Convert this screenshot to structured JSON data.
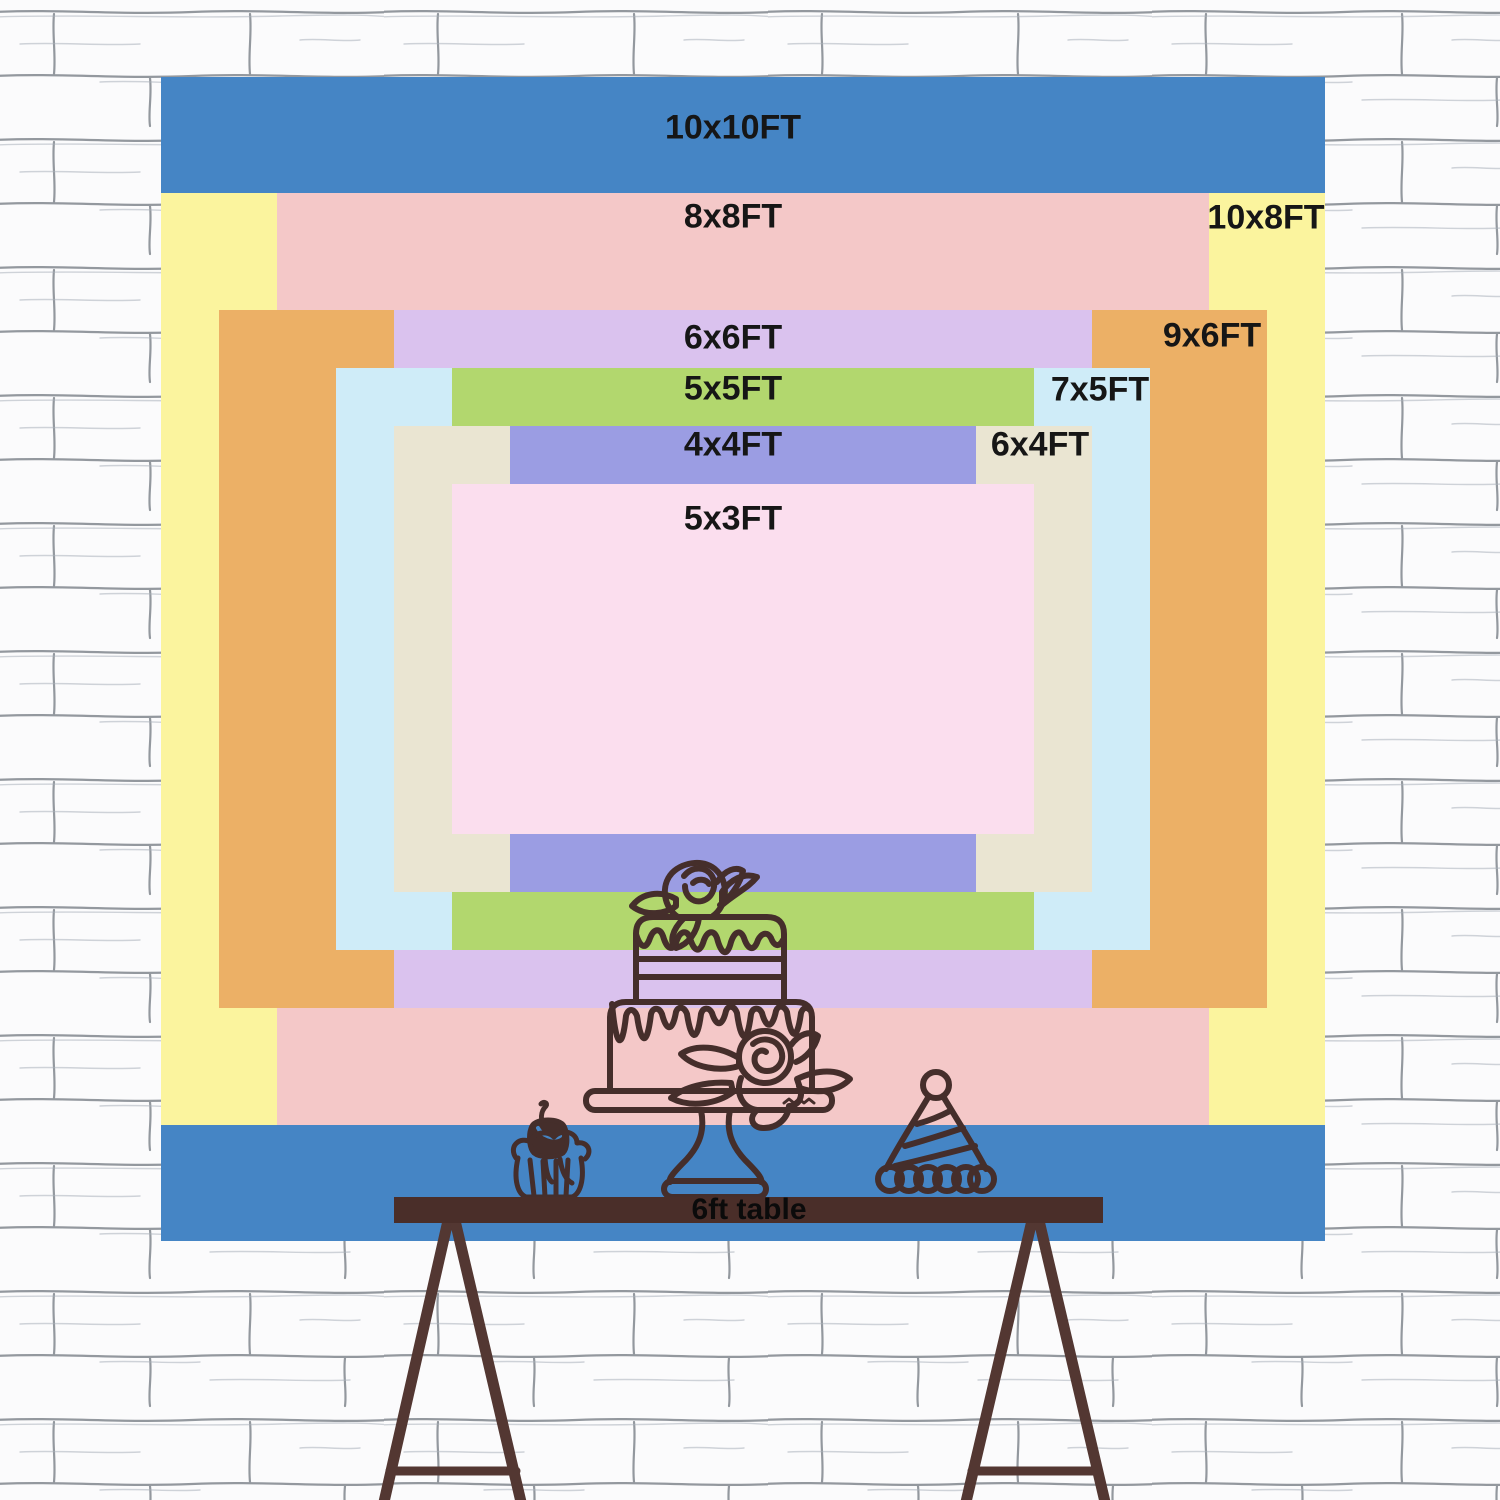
{
  "backdrop": {
    "unit": "FT",
    "scale_px_per_ft": 116.4,
    "center": {
      "x": 743,
      "y": 659
    },
    "sizes": [
      {
        "id": "10x10",
        "label": "10x10FT",
        "width_ft": 10,
        "height_ft": 10,
        "color": "#4585c5",
        "label_x": 733,
        "label_y": 128
      },
      {
        "id": "10x8",
        "label": "10x8FT",
        "width_ft": 10,
        "height_ft": 8,
        "color": "#fbf49e",
        "label_x": 1266,
        "label_y": 218
      },
      {
        "id": "8x8",
        "label": "8x8FT",
        "width_ft": 8,
        "height_ft": 8,
        "color": "#f4c8c8",
        "label_x": 733,
        "label_y": 217
      },
      {
        "id": "9x6",
        "label": "9x6FT",
        "width_ft": 9,
        "height_ft": 6,
        "color": "#ecb066",
        "label_x": 1212,
        "label_y": 336
      },
      {
        "id": "6x6",
        "label": "6x6FT",
        "width_ft": 6,
        "height_ft": 6,
        "color": "#dac2ee",
        "label_x": 733,
        "label_y": 338
      },
      {
        "id": "7x5",
        "label": "7x5FT",
        "width_ft": 7,
        "height_ft": 5,
        "color": "#cfecf8",
        "label_x": 1100,
        "label_y": 390
      },
      {
        "id": "5x5",
        "label": "5x5FT",
        "width_ft": 5,
        "height_ft": 5,
        "color": "#b2d76e",
        "label_x": 733,
        "label_y": 389
      },
      {
        "id": "6x4",
        "label": "6x4FT",
        "width_ft": 6,
        "height_ft": 4,
        "color": "#eae5d2",
        "label_x": 1040,
        "label_y": 445
      },
      {
        "id": "4x4",
        "label": "4x4FT",
        "width_ft": 4,
        "height_ft": 4,
        "color": "#9b9de3",
        "label_x": 733,
        "label_y": 445
      },
      {
        "id": "5x3",
        "label": "5x3FT",
        "width_ft": 5,
        "height_ft": 3,
        "color": "#fbdeee",
        "label_x": 733,
        "label_y": 519
      }
    ]
  },
  "table": {
    "label": "6ft table",
    "label_x": 749,
    "label_y": 1210,
    "bar_color": "#4a2e29",
    "leg_color": "#533732"
  },
  "illustrations": {
    "stroke_color": "#452e2b",
    "items": [
      "tiered-cake-on-stand",
      "cherry-cupcake",
      "party-hat"
    ]
  },
  "wall": {
    "background": "#fbfbfc",
    "mortar_line_color": "#70767f"
  }
}
